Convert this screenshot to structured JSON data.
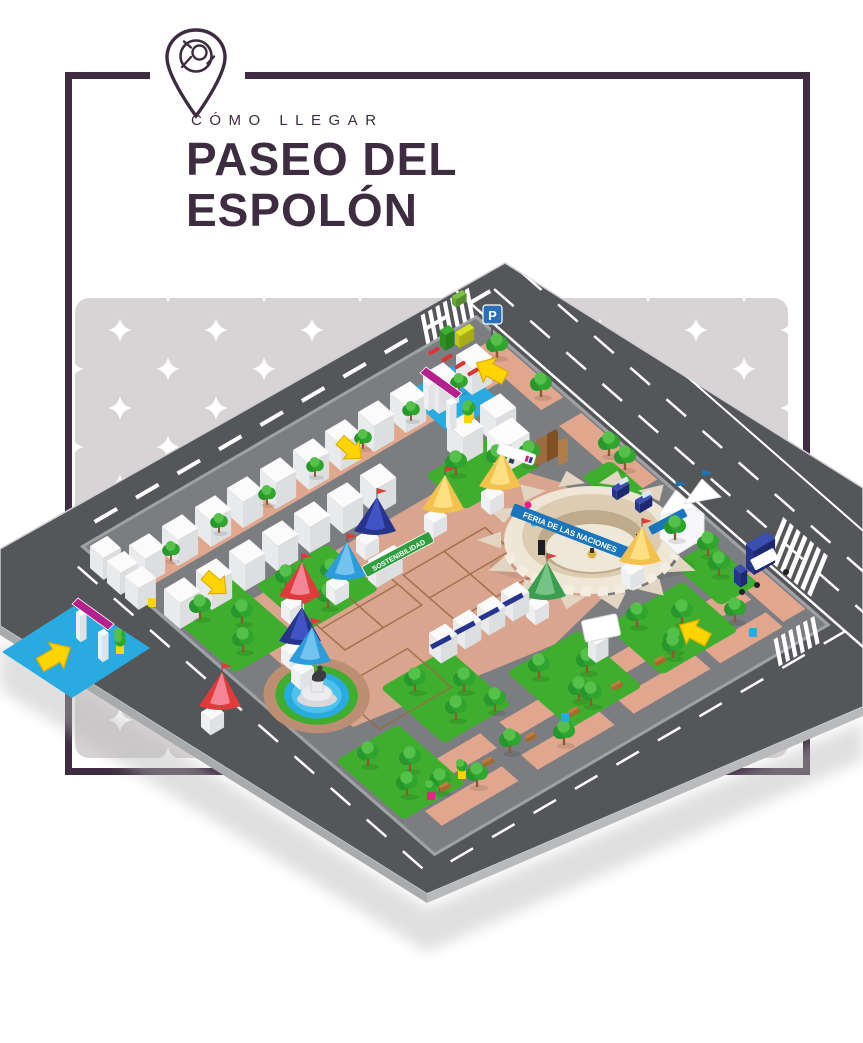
{
  "header": {
    "kicker": "CÓMO LLEGAR",
    "title_line1": "PASEO DEL",
    "title_line2": "ESPOLÓN"
  },
  "map": {
    "parking_sign": "P",
    "stage_banner": "FERIA DE LAS NACIONES",
    "signs": {
      "sustainability": "SOSTENIBILIDAD",
      "puerto_rico_line1": "PUERTO",
      "puerto_rico_line2": "RICO",
      "toilets": "ASEOS"
    }
  },
  "icons": {
    "pin": "location-pin-icon",
    "parking": "parking-sign-icon",
    "arrow": "direction-arrow-icon",
    "star": "sparkle-star-icon"
  },
  "colors": {
    "ink": "#3E2C40",
    "star-bg": "#D8D3D4",
    "road": "#545659",
    "pavement": "#7B7D80",
    "curb": "#9FA1A4",
    "lawn": "#3FAE2E",
    "salmon": "#E0A78E",
    "path-brown": "#BC8E73",
    "water": "#29ABE2",
    "cream": "#ECE2D2",
    "magenta": "#B5208E",
    "banner-blue": "#1B75BC",
    "navy": "#27348B",
    "yellow": "#FFD400",
    "green-sign": "#2F9E41",
    "parking-blue": "#2A6FB8"
  }
}
